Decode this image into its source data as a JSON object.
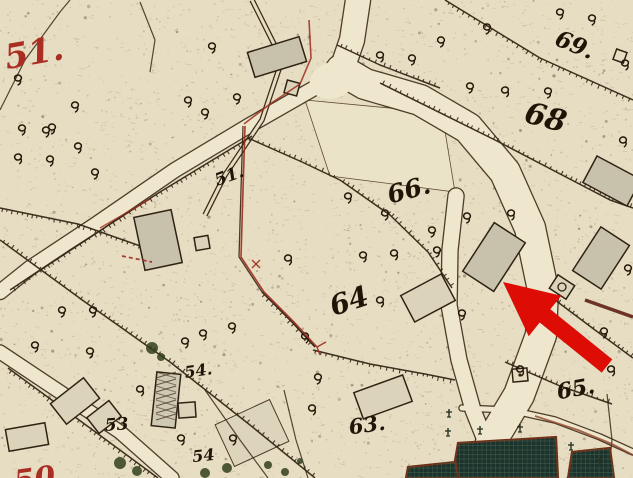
{
  "map": {
    "type": "historic-cadastral-map",
    "palette": {
      "paper": "#e6ddc3",
      "road": "#efe7cd",
      "ink": "#2b1d10",
      "building_fill": "#c8c2ac",
      "building_pale": "#dbd3ba",
      "garden_green": "#1b332c",
      "red_label": "#aa2e22",
      "red_line": "#9e2b1c",
      "arrow_red": "#dd0d06"
    },
    "parcel_labels": [
      {
        "id": "sheet-51",
        "text": "51.",
        "x": 36,
        "y": 64,
        "size": 34,
        "rot": -10,
        "red": true
      },
      {
        "id": "parcel-69",
        "text": "69.",
        "x": 572,
        "y": 52,
        "size": 23,
        "rot": 22,
        "red": false
      },
      {
        "id": "parcel-68",
        "text": "68",
        "x": 543,
        "y": 127,
        "size": 30,
        "rot": 15,
        "red": false
      },
      {
        "id": "parcel-66",
        "text": "66.",
        "x": 411,
        "y": 198,
        "size": 25,
        "rot": -15,
        "red": false
      },
      {
        "id": "parcel-51",
        "text": "51.",
        "x": 231,
        "y": 181,
        "size": 17,
        "rot": -20,
        "red": false
      },
      {
        "id": "parcel-64",
        "text": "64",
        "x": 352,
        "y": 310,
        "size": 28,
        "rot": -18,
        "red": false
      },
      {
        "id": "parcel-63",
        "text": "63.",
        "x": 368,
        "y": 432,
        "size": 21,
        "rot": -8,
        "red": false
      },
      {
        "id": "parcel-65",
        "text": "65.",
        "x": 577,
        "y": 396,
        "size": 22,
        "rot": -10,
        "red": false
      },
      {
        "id": "parcel-53",
        "text": "53",
        "x": 117,
        "y": 430,
        "size": 17,
        "rot": -4,
        "red": false
      },
      {
        "id": "parcel-54a",
        "text": "54.",
        "x": 199,
        "y": 376,
        "size": 16,
        "rot": -8,
        "red": false
      },
      {
        "id": "parcel-54b",
        "text": "54",
        "x": 204,
        "y": 461,
        "size": 16,
        "rot": -6,
        "red": false
      },
      {
        "id": "sheet-50",
        "text": "50",
        "x": 36,
        "y": 489,
        "size": 30,
        "rot": -8,
        "red": true
      }
    ],
    "annotation_arrow": {
      "tip_x": 503,
      "tip_y": 282,
      "tail_x": 607,
      "tail_y": 366,
      "head_len": 54,
      "head_half_w": 26,
      "shaft_half_w": 8.5
    },
    "symbols": {
      "tree": "deciduous-tree-glyph",
      "conifer": "conifer-cross-glyph",
      "garden_bed": "cross-hatched-garden-bed"
    }
  }
}
